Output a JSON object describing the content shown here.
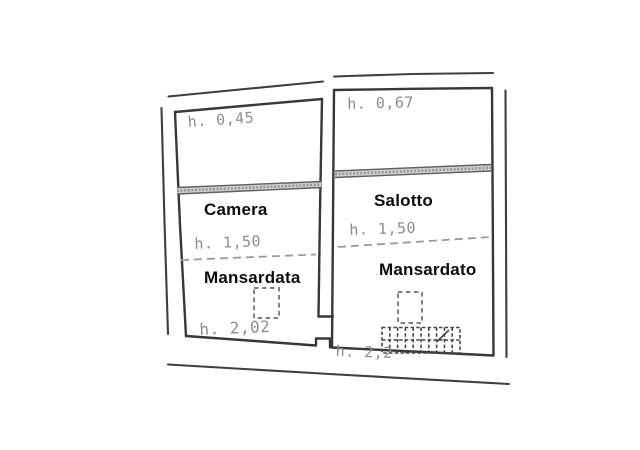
{
  "plan": {
    "background": "#ffffff",
    "wall_line_color": "#3a3a3a",
    "annotation_color": "#8c8c8c",
    "room_label_color": "#0c0c0c",
    "rooms": {
      "camera": {
        "name": "Camera",
        "zone": "Mansardata",
        "h_top": "h. 0,45",
        "h_mid": "h. 1,50",
        "h_bottom": "h. 2,02"
      },
      "salotto": {
        "name": "Salotto",
        "zone": "Mansardato",
        "h_top": "h. 0,67",
        "h_mid": "h. 1,50",
        "h_bottom": "h. 2,2"
      }
    }
  }
}
